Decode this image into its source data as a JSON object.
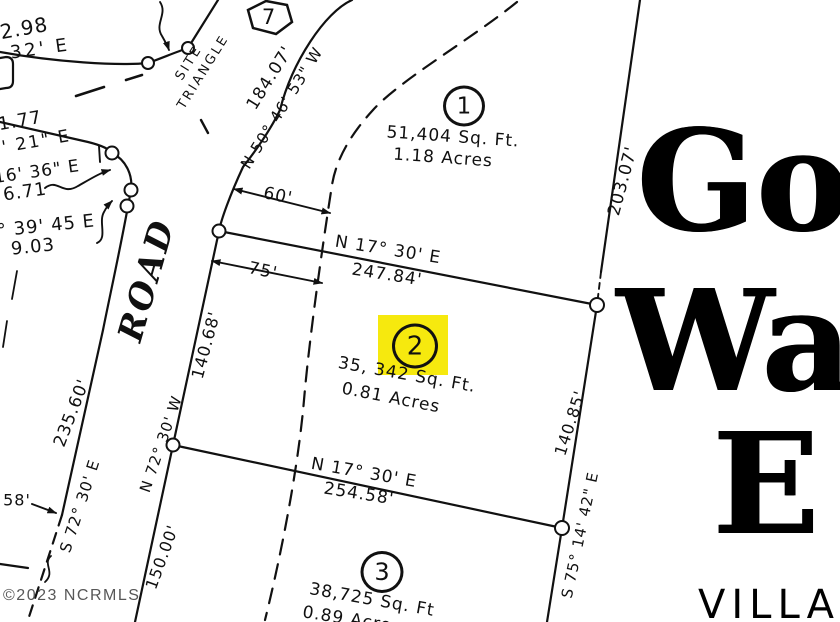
{
  "road": {
    "name": "ROAD"
  },
  "site_triangle": {
    "line1": "SITE",
    "line2": "TRIANGLE"
  },
  "markers": {
    "hex_lot": "7"
  },
  "lots": {
    "lot1": {
      "number": "1",
      "area_sqft": "51,404 Sq. Ft.",
      "area_acres": "1.18 Acres"
    },
    "lot2": {
      "number": "2",
      "area_sqft": "35, 342 Sq. Ft.",
      "area_acres": "0.81 Acres",
      "highlight_color": "#f6e90e"
    },
    "lot3": {
      "number": "3",
      "area_sqft": "38,725 Sq. Ft",
      "area_acres": "0.89 Acres"
    }
  },
  "bearings": {
    "road_curve_bearing": "N 50° 46' 53\" W",
    "road_curve_dist": "184.07'",
    "lot12_bearing": "N 17° 30' E",
    "lot12_dist": "247.84'",
    "lot23_bearing": "N 17° 30' E",
    "lot23_dist": "254.58'",
    "right_dist_top": "203.07'",
    "right_dist_mid": "140.85'",
    "right_bearing": "S 75° 14' 42\" E",
    "west_dist_14068": "140.68'",
    "west_bearing_n72": "N 72° 30' W",
    "west_dist_150": "150.00'",
    "left_dist_23560": "235.60'",
    "left_bearing_s72": "S 72° 30' E"
  },
  "dimensions": {
    "d60": "60'",
    "d75": "75'",
    "d58": "58'"
  },
  "fragments": {
    "f298": "2.98",
    "f32e": "32' E",
    "f177": "1.77",
    "f621e": "6' 21\" E",
    "f1636e": "16' 36\" E",
    "f671": "6.71",
    "f3945e": "° 39' 45 E",
    "f903": "9.03"
  },
  "watermark": "©2023 NCRMLS",
  "gothic_text": {
    "line1": "Golf",
    "line2": "Walk",
    "line3": "Es",
    "line4": "VILLA"
  }
}
